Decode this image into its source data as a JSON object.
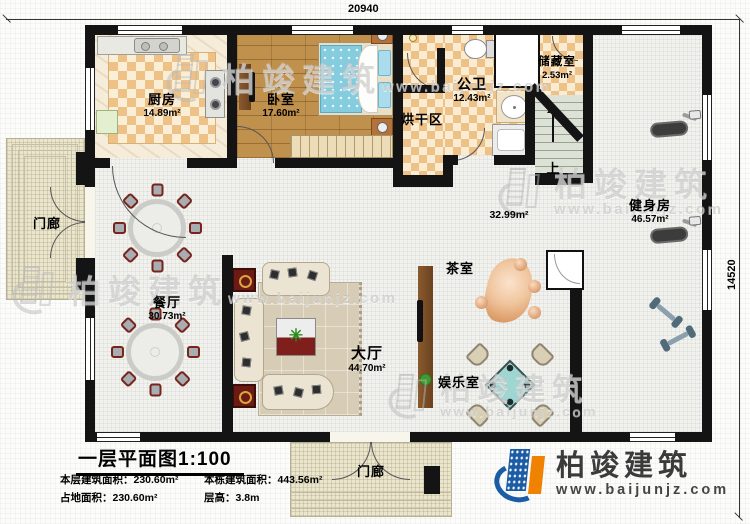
{
  "dimensions": {
    "top": "20940",
    "right": "14520"
  },
  "rooms": {
    "kitchen": {
      "name": "厨房",
      "area": "14.89m²"
    },
    "bedroom": {
      "name": "卧室",
      "area": "17.60m²"
    },
    "bathroom": {
      "name": "公卫",
      "area": "12.43m²"
    },
    "storage": {
      "name": "储藏室",
      "area": "2.53m²"
    },
    "drying": {
      "name": "烘干区"
    },
    "gym": {
      "name": "健身房",
      "area": "46.57m²"
    },
    "dining": {
      "name": "餐厅",
      "area": "30.73m²"
    },
    "hall": {
      "name": "大厅",
      "area": "44.70m²"
    },
    "tea": {
      "name": "茶室"
    },
    "entertainment": {
      "name": "娱乐室"
    },
    "porch_left": {
      "name": "门廊"
    },
    "porch_bottom": {
      "name": "门廊"
    },
    "hall_area_note": "32.99m²",
    "stairs_up": "上"
  },
  "title_block": {
    "title": "一层平面图1:100",
    "stats": [
      {
        "label": "本层建筑面积：",
        "value": "230.60m²"
      },
      {
        "label": "本栋建筑面积：",
        "value": "443.56m²"
      },
      {
        "label": "占地面积：",
        "value": "230.60m²"
      },
      {
        "label": "层高：",
        "value": "3.8m"
      }
    ]
  },
  "branding": {
    "company": "柏竣建筑",
    "website": "www.baijunjz.com"
  },
  "watermark": {
    "text": "柏竣建筑",
    "subtext": "www.baijunjz.com"
  },
  "colors": {
    "brand_blue": "#1b5ca5",
    "brand_orange": "#ef8200",
    "wall_black": "#141414",
    "checker_tan": "#eec287",
    "wood_brown": "#c0914c",
    "stair_green": "#dce2d6",
    "mahjong_teal": "#9fd6d2",
    "tea_table_orange": "#e8a878"
  }
}
